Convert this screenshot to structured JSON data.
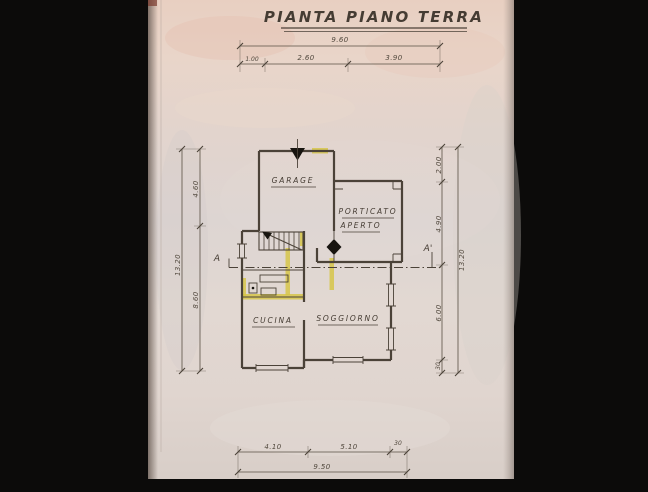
{
  "title": "PIANTA PIANO TERRA",
  "plan": {
    "rooms": {
      "garage": {
        "label": "GARAGE"
      },
      "porticato": {
        "label_line1": "PORTICATO",
        "label_line2": "APERTO"
      },
      "cucina": {
        "label": "CUCINA"
      },
      "soggiorno": {
        "label": "SOGGIORNO"
      }
    },
    "section_markers": {
      "left": "A",
      "right": "A'"
    }
  },
  "dimensions": {
    "top": {
      "total": "9.60",
      "segments": [
        "1.00",
        "2.60",
        "3.90"
      ]
    },
    "bottom": {
      "total": "9.50",
      "segments": [
        "4.10",
        "5.10",
        "30"
      ]
    },
    "left": {
      "total": "13.20",
      "segments": [
        "4.60",
        "8.60"
      ]
    },
    "right": {
      "total": "13.20",
      "segments": [
        "2.00",
        "4.90",
        "6.00",
        "30"
      ]
    }
  },
  "icons": {
    "entrance_arrow": "solid down-triangle door marker on garage top wall",
    "door_diamond": "solid diamond door marker at porticato entry",
    "stair_arrow": "staircase direction arrow"
  },
  "colors": {
    "scan_background": "#0c0b0a",
    "paper": "#e0d6d0",
    "paper_pink_tint": "#e9d0c2",
    "ink": "#4b4238",
    "wall_highlight": "#d6c544",
    "marker_black": "#17140f"
  }
}
